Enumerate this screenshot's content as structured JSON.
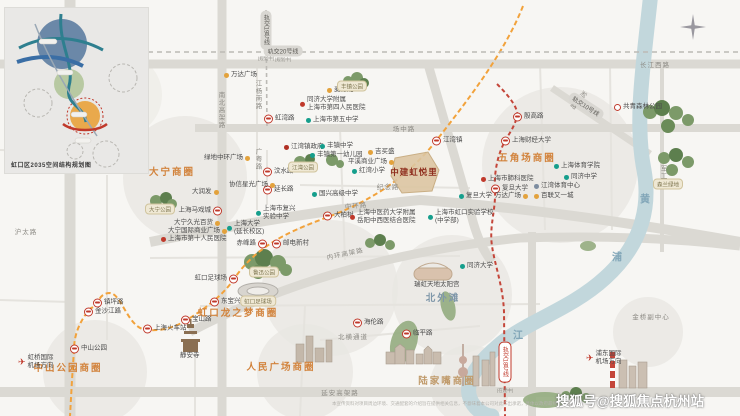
{
  "inset": {
    "caption": "虹口区2035空间结构规划图"
  },
  "project": {
    "name": "中建虹悦里",
    "x": 414,
    "y": 172
  },
  "watermark": "搜狐号@搜狐焦点杭州站",
  "disclaimer": "本宣传资料对项目周边环境、交通配套的介绍旨在提供相关信息，不意味着本公司对此作出承诺，具体以政府最终规划为准。",
  "colors": {
    "business_circle_label": "#d2833c",
    "beitan_label": "#7f97a9",
    "metro_red": "#c0392b",
    "line3_orange": "#f2a23b",
    "school_teal": "#159e8c",
    "shop_orange": "#e3a23c",
    "project_red": "#8f2f1f"
  },
  "business_circles": [
    {
      "name": "大宁商圈",
      "x": 172,
      "y": 171,
      "color": "#d2833c"
    },
    {
      "name": "五角场商圈",
      "x": 527,
      "y": 157,
      "color": "#d2833c"
    },
    {
      "name": "虹口龙之梦商圈",
      "x": 238,
      "y": 312,
      "color": "#d2833c"
    },
    {
      "name": "北外滩",
      "x": 443,
      "y": 297,
      "color": "#7f97a9"
    },
    {
      "name": "中山公园商圈",
      "x": 68,
      "y": 367,
      "color": "#d2833c"
    },
    {
      "name": "人民广场商圈",
      "x": 281,
      "y": 366,
      "color": "#d2833c"
    },
    {
      "name": "陆家嘴商圈",
      "x": 447,
      "y": 380,
      "color": "#c09a6a"
    }
  ],
  "road_labels": [
    {
      "t": "长江西路",
      "x": 655,
      "y": 64
    },
    {
      "t": "场中路",
      "x": 404,
      "y": 128
    },
    {
      "t": "纪念路",
      "x": 388,
      "y": 186
    },
    {
      "t": "中环路",
      "x": 356,
      "y": 205,
      "r": -6
    },
    {
      "t": "内环高架路",
      "x": 345,
      "y": 253,
      "r": -12
    },
    {
      "t": "延安高架路",
      "x": 340,
      "y": 392
    },
    {
      "t": "北横通道",
      "x": 353,
      "y": 336
    },
    {
      "t": "沪太路",
      "x": 26,
      "y": 231
    },
    {
      "t": "江杨南路",
      "x": 257,
      "y": 95,
      "v": true
    },
    {
      "t": "广粤路",
      "x": 257,
      "y": 159,
      "v": true
    },
    {
      "t": "南北高架路",
      "x": 220,
      "y": 110,
      "v": true
    },
    {
      "t": "军工路",
      "x": 662,
      "y": 176,
      "v": true
    },
    {
      "t": "淞沪路",
      "x": 577,
      "y": 99,
      "v": true,
      "r": 40
    },
    {
      "t": "金桥副中心",
      "x": 651,
      "y": 316
    }
  ],
  "metro_pills": [
    {
      "t": "轨交20号线",
      "sub": "(规划中)",
      "x": 283,
      "y": 51
    },
    {
      "t": "轨交19号线",
      "sub": "(规划中)",
      "x": 266,
      "y": 30,
      "v": true
    },
    {
      "t": "轨交10号线",
      "x": 586,
      "y": 106,
      "r": 33
    },
    {
      "t": "轨交18号线",
      "sub": "(在建中)",
      "x": 505,
      "y": 362,
      "v": true,
      "red": true
    }
  ],
  "stations": [
    {
      "t": "虹湾路",
      "x": 268,
      "y": 119
    },
    {
      "t": "江湾镇",
      "x": 436,
      "y": 141
    },
    {
      "t": "大柏树",
      "x": 327,
      "y": 216
    },
    {
      "t": "赤峰路",
      "x": 263,
      "y": 244,
      "side": "left"
    },
    {
      "t": "邮电新村",
      "x": 276,
      "y": 244
    },
    {
      "t": "虹口足球场",
      "x": 234,
      "y": 279,
      "side": "left"
    },
    {
      "t": "东宝兴路",
      "x": 214,
      "y": 302
    },
    {
      "t": "宝山路",
      "x": 185,
      "y": 320
    },
    {
      "t": "上海火车站",
      "x": 147,
      "y": 329
    },
    {
      "t": "镇坪路",
      "x": 97,
      "y": 303
    },
    {
      "t": "金沙江路",
      "x": 88,
      "y": 312
    },
    {
      "t": "中山公园",
      "x": 74,
      "y": 349
    },
    {
      "t": "上海马戏城",
      "x": 218,
      "y": 211,
      "side": "left"
    },
    {
      "t": "汶水路",
      "x": 267,
      "y": 172
    },
    {
      "t": "延长路",
      "x": 267,
      "y": 190
    },
    {
      "t": "殷高路",
      "x": 517,
      "y": 117
    },
    {
      "t": "上海财经大学",
      "x": 505,
      "y": 141
    },
    {
      "t": "复旦大学",
      "x": 495,
      "y": 189
    },
    {
      "t": "海伦路",
      "x": 357,
      "y": 323
    },
    {
      "t": "临平路",
      "x": 406,
      "y": 334
    }
  ],
  "pois": [
    {
      "t": [
        "万达广场"
      ],
      "type": "shop",
      "x": 224,
      "y": 75
    },
    {
      "t": [
        "麦德龙"
      ],
      "type": "shop",
      "x": 327,
      "y": 90
    },
    {
      "t": [
        "同济大学附属",
        "上海市第四人民医院"
      ],
      "type": "hospital",
      "x": 300,
      "y": 104
    },
    {
      "t": [
        "上海市第五中学"
      ],
      "type": "school",
      "x": 306,
      "y": 120
    },
    {
      "t": [
        "江湾镇政府"
      ],
      "type": "gov",
      "x": 284,
      "y": 147
    },
    {
      "t": [
        "丰镇中学"
      ],
      "type": "school",
      "x": 320,
      "y": 146
    },
    {
      "t": [
        "丰镇第一幼儿园"
      ],
      "type": "school",
      "x": 310,
      "y": 155
    },
    {
      "t": [
        "平溪商业广场"
      ],
      "type": "shop",
      "x": 348,
      "y": 162,
      "side": "right"
    },
    {
      "t": [
        "吉买盛"
      ],
      "type": "shop",
      "x": 368,
      "y": 152
    },
    {
      "t": [
        "红湾小学"
      ],
      "type": "school",
      "x": 352,
      "y": 171
    },
    {
      "t": [
        "国兴高级中学"
      ],
      "type": "school",
      "x": 312,
      "y": 194
    },
    {
      "t": [
        "上海市复兴",
        "实验中学"
      ],
      "type": "school",
      "x": 256,
      "y": 213
    },
    {
      "t": [
        "上海中医药大学附属",
        "岳阳中西医结合医院"
      ],
      "type": "hospital",
      "x": 350,
      "y": 217
    },
    {
      "t": [
        "上海市虹口实验学校",
        "(中学部)"
      ],
      "type": "school",
      "x": 428,
      "y": 217
    },
    {
      "t": [
        "绿地中环广场"
      ],
      "type": "shop",
      "x": 204,
      "y": 158,
      "side": "right"
    },
    {
      "t": [
        "协信星光广场"
      ],
      "type": "shop",
      "x": 229,
      "y": 185,
      "side": "right"
    },
    {
      "t": [
        "大润发"
      ],
      "type": "shop",
      "x": 192,
      "y": 192,
      "side": "right"
    },
    {
      "t": [
        "大宁久光百货"
      ],
      "type": "shop",
      "x": 174,
      "y": 223,
      "side": "right"
    },
    {
      "t": [
        "大宁国际商业广场"
      ],
      "type": "shop",
      "x": 168,
      "y": 231,
      "side": "right"
    },
    {
      "t": [
        "上海市第十人民医院"
      ],
      "type": "hospital",
      "x": 161,
      "y": 239
    },
    {
      "t": [
        "上海大学",
        "(延长校区)"
      ],
      "type": "school",
      "x": 227,
      "y": 228
    },
    {
      "t": [
        "复旦大学"
      ],
      "type": "school",
      "x": 459,
      "y": 196
    },
    {
      "t": [
        "上海市肺科医院"
      ],
      "type": "hospital",
      "x": 481,
      "y": 179
    },
    {
      "t": [
        "万达广场"
      ],
      "type": "shop",
      "x": 495,
      "y": 196,
      "side": "right"
    },
    {
      "t": [
        "百联又一城"
      ],
      "type": "shop",
      "x": 534,
      "y": 196
    },
    {
      "t": [
        "同济中学"
      ],
      "type": "school",
      "x": 564,
      "y": 177
    },
    {
      "t": [
        "上海体育学院"
      ],
      "type": "school",
      "x": 554,
      "y": 166
    },
    {
      "t": [
        "江湾体育中心"
      ],
      "type": "venue",
      "x": 534,
      "y": 186
    },
    {
      "t": [
        "同济大学"
      ],
      "type": "school",
      "x": 460,
      "y": 266
    },
    {
      "t": [
        "瑞虹天地太阳宫"
      ],
      "type": "plain",
      "x": 414,
      "y": 285
    },
    {
      "t": [
        "静安寺"
      ],
      "type": "plain",
      "x": 180,
      "y": 356
    },
    {
      "t": [
        "共青森林公园"
      ],
      "type": "spot",
      "x": 614,
      "y": 107
    },
    {
      "t": [
        "✈",
        "虹桥国际",
        "机场方向"
      ],
      "type": "plane",
      "x": 18,
      "y": 362
    },
    {
      "t": [
        "✈",
        "浦东国际",
        "机场方向"
      ],
      "type": "plane",
      "x": 586,
      "y": 358
    }
  ],
  "parks": [
    {
      "t": "丰镇公园",
      "x": 352,
      "y": 86
    },
    {
      "t": "江湾公园",
      "x": 303,
      "y": 167
    },
    {
      "t": "大宁公园",
      "x": 160,
      "y": 209
    },
    {
      "t": "鲁迅公园",
      "x": 264,
      "y": 272
    },
    {
      "t": "虹口足球场",
      "x": 258,
      "y": 301
    },
    {
      "t": "森兰绿地",
      "x": 668,
      "y": 184
    }
  ],
  "river_chars": [
    {
      "ch": "黄",
      "x": 645,
      "y": 198
    },
    {
      "ch": "浦",
      "x": 617,
      "y": 256
    },
    {
      "ch": "江",
      "x": 518,
      "y": 334
    }
  ]
}
